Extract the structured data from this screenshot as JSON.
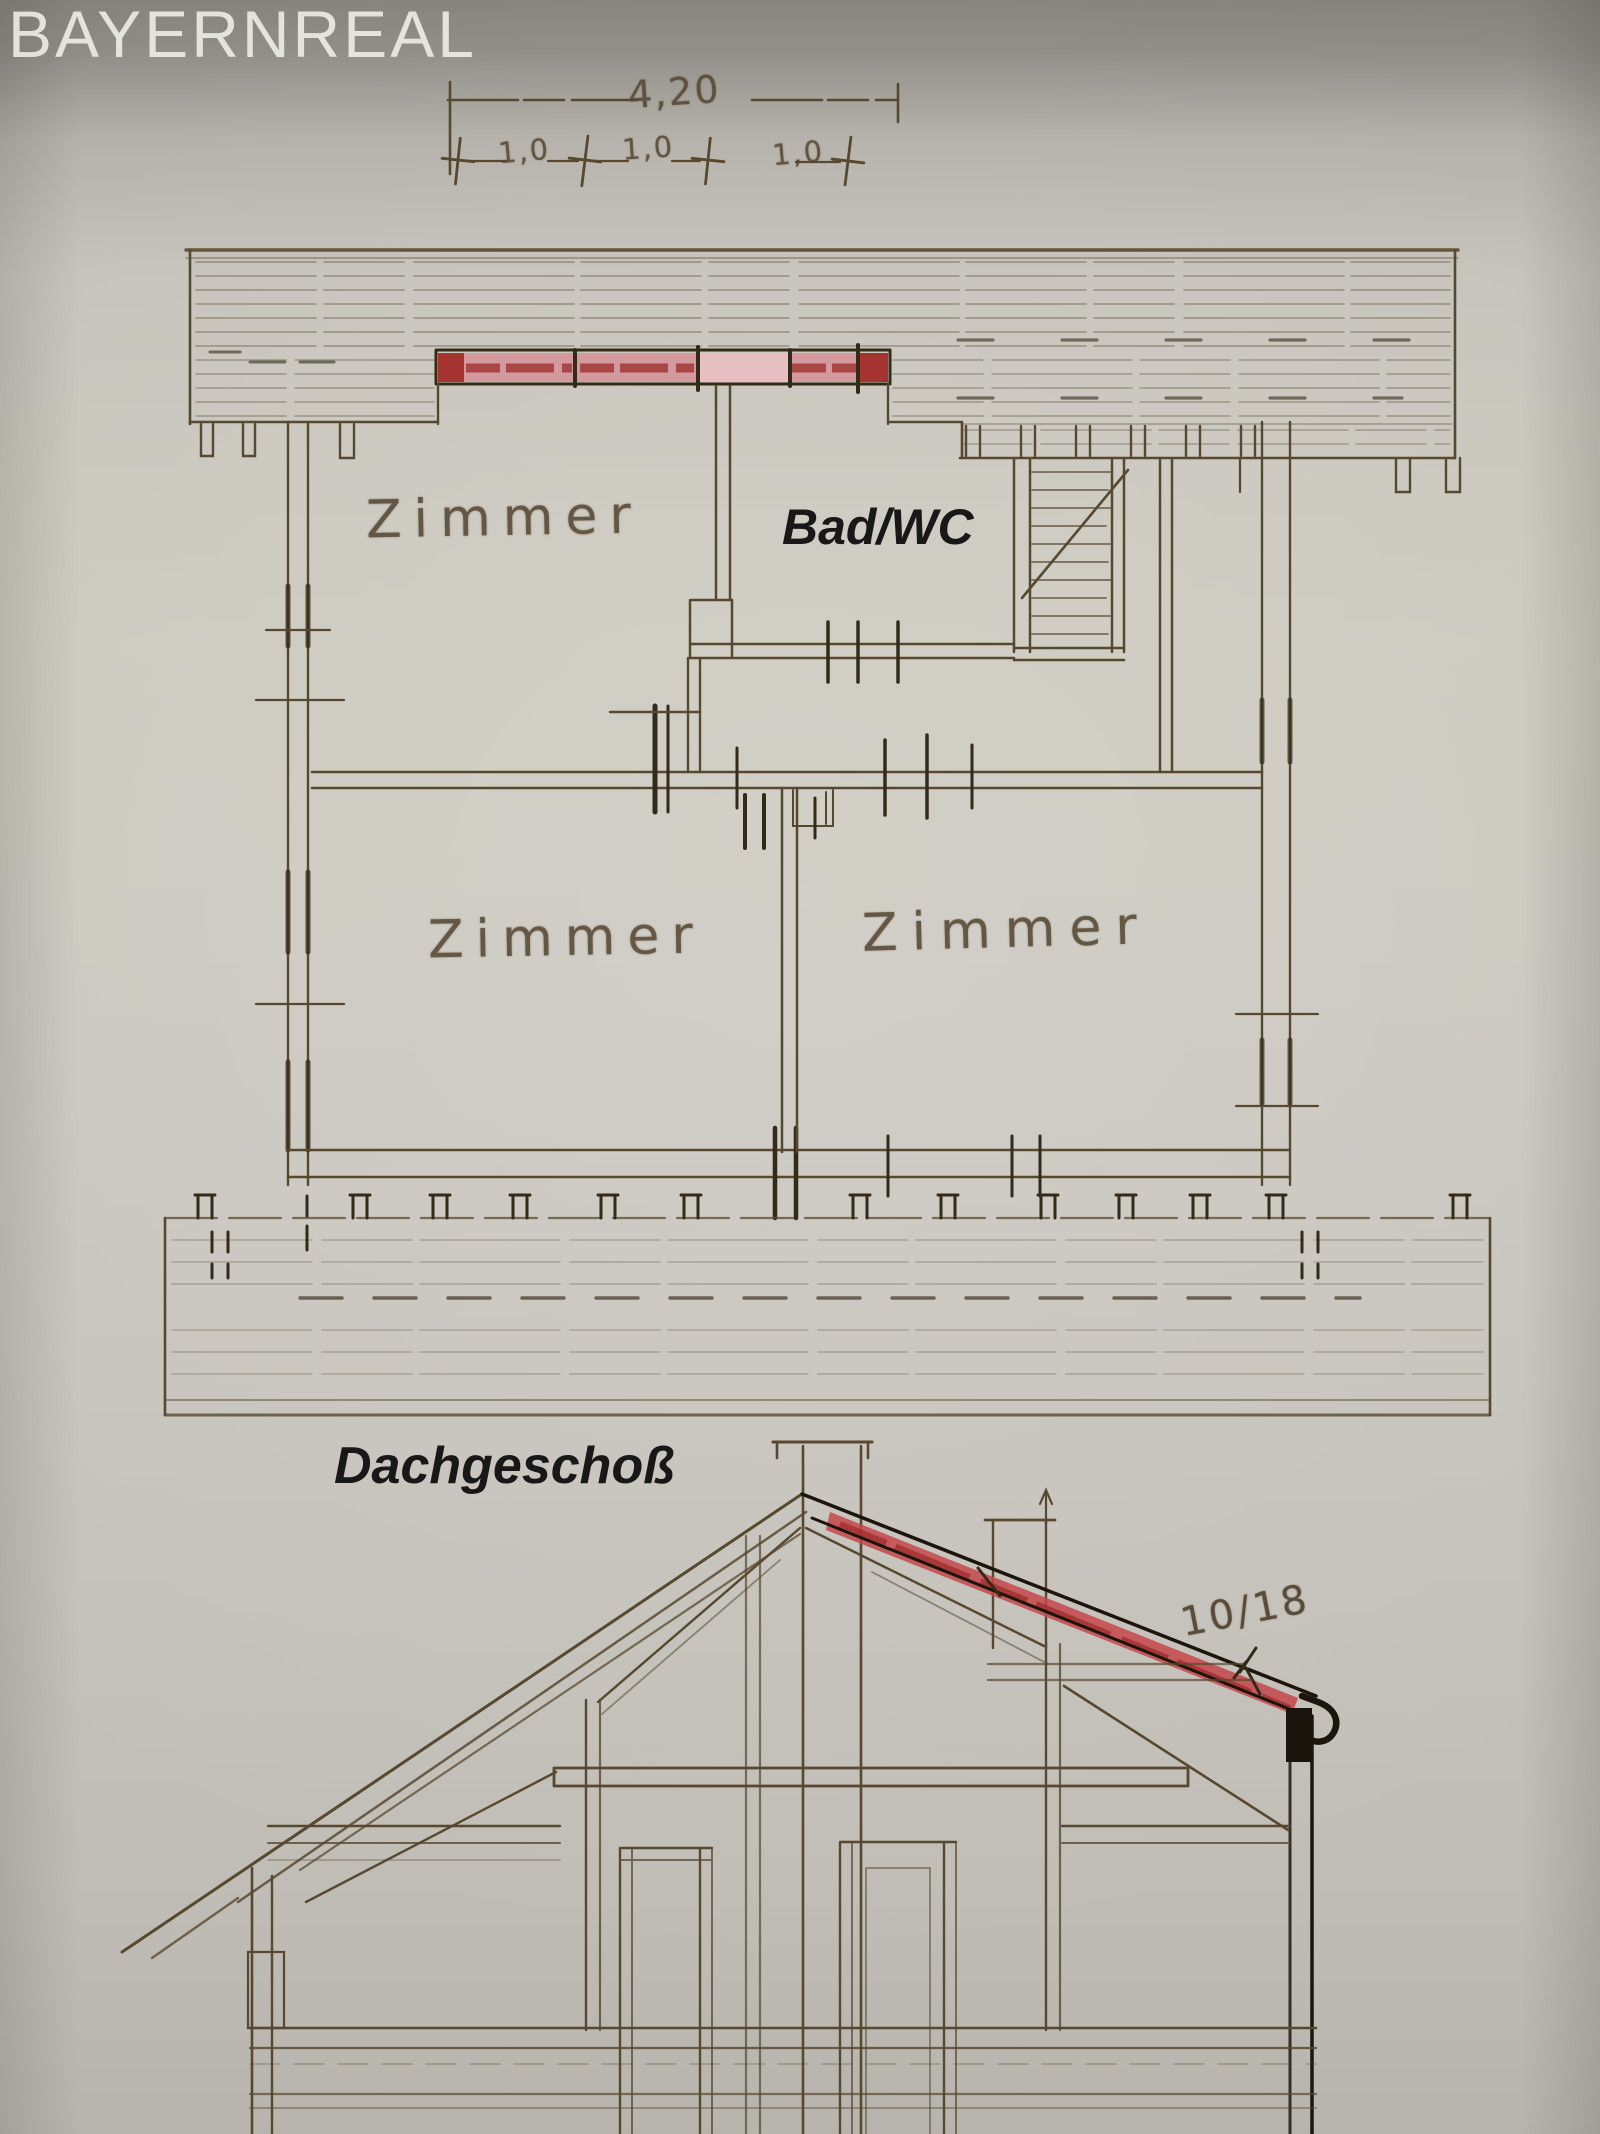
{
  "watermark": {
    "text": "BAYERNREAL"
  },
  "dimensions": {
    "total": "4,20",
    "seg1": "1,0",
    "seg2": "1,0",
    "seg3": "1,0"
  },
  "rooms": {
    "top_left": "Zimmer",
    "bath": "Bad/WC",
    "bottom_left": "Zimmer",
    "bottom_right": "Zimmer"
  },
  "labels": {
    "floor": "Dachgeschoß",
    "rafter_dimension": "10/18"
  },
  "colors": {
    "paper": "#cac7c0",
    "ink_sepia": "#57492f",
    "ink_dark": "#342a18",
    "ink_black": "#1c150c",
    "highlight_red": "#c2474b",
    "highlight_red_dark": "#a53431",
    "highlight_pink_light": "#e5bfc2",
    "label_black": "#181818",
    "watermark_gray": "#f0efeb"
  }
}
